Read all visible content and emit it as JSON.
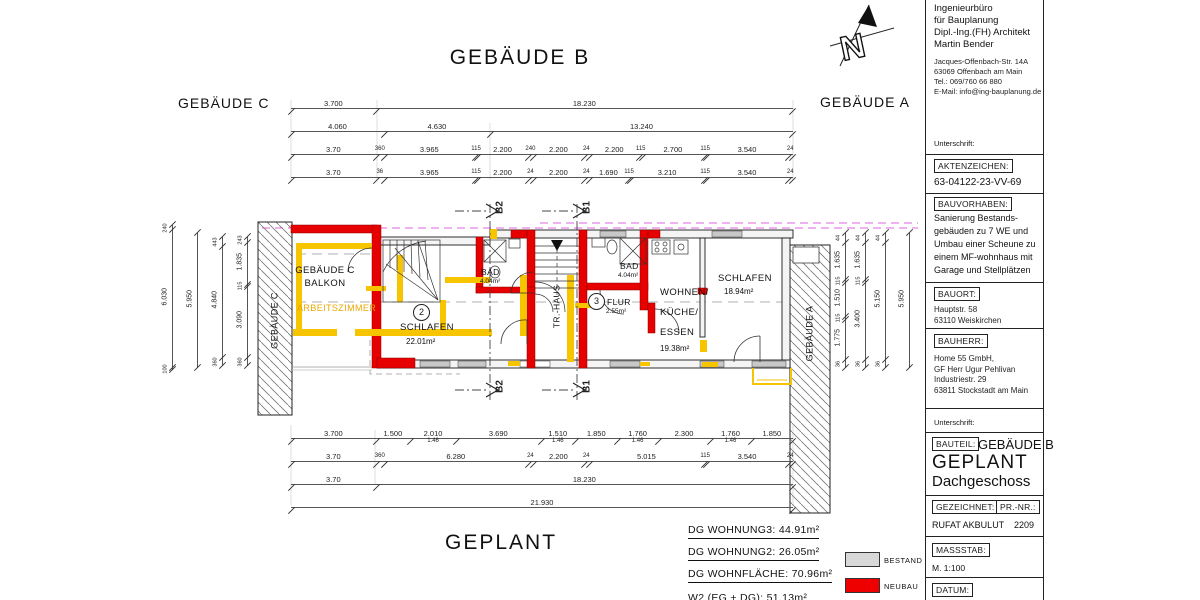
{
  "compass": {
    "n": "N"
  },
  "headings": {
    "building_b": "GEBÄUDE B",
    "building_c": "GEBÄUDE C",
    "building_a": "GEBÄUDE A",
    "caption": "GEPLANT"
  },
  "plan": {
    "strip_left": "GEBÄUDE C",
    "strip_right": "GEBÄUDE A",
    "balkon_line1": "GEBÄUDE C",
    "balkon_line2": "BALKON",
    "arbeitszimmer": "ARBEITSZIMMER",
    "schlafen2_num": "2",
    "schlafen2_name": "SCHLAFEN",
    "schlafen2_area": "22.01m²",
    "bad_left_name": "BAD",
    "bad_left_area": "4.04m²",
    "trhaus": "TR.-HAUS",
    "bad_right_name": "BAD",
    "bad_right_area": "4.04m²",
    "flur_num": "3",
    "flur_name": "FLUR",
    "flur_area": "2.55m²",
    "wohnen_line1": "WOHNEN/",
    "wohnen_line2": "KÜCHE/",
    "wohnen_line3": "ESSEN",
    "wohnen_area": "19.38m²",
    "schlafen1_name": "SCHLAFEN",
    "schlafen1_area": "18.94m²",
    "section_b1": "B1",
    "section_b2": "B2"
  },
  "dims": {
    "top_rows": [
      [
        {
          "t": "3.700",
          "w": 3.7
        },
        {
          "t": "18.230",
          "w": 18.23
        }
      ],
      [
        {
          "t": "4.060",
          "w": 4.06
        },
        {
          "t": "4.630",
          "w": 4.63
        },
        {
          "t": "13.240",
          "w": 13.24
        }
      ],
      [
        {
          "t": "3.70",
          "w": 3.7
        },
        {
          "t": "360",
          "w": 0.36
        },
        {
          "t": "3.965",
          "w": 3.965
        },
        {
          "t": "115",
          "w": 0.115
        },
        {
          "t": "2.200",
          "w": 2.2
        },
        {
          "t": "240",
          "w": 0.24
        },
        {
          "t": "2.200",
          "w": 2.2
        },
        {
          "t": "24",
          "w": 0.24
        },
        {
          "t": "2.200",
          "w": 2.2
        },
        {
          "t": "115",
          "w": 0.115
        },
        {
          "t": "2.700",
          "w": 2.7
        },
        {
          "t": "115",
          "w": 0.115
        },
        {
          "t": "3.540",
          "w": 3.54
        },
        {
          "t": "24",
          "w": 0.24
        }
      ],
      [
        {
          "t": "3.70",
          "w": 3.7
        },
        {
          "t": "36",
          "w": 0.36
        },
        {
          "t": "3.965",
          "w": 3.965
        },
        {
          "t": "115",
          "w": 0.115
        },
        {
          "t": "2.200",
          "w": 2.2
        },
        {
          "t": "24",
          "w": 0.24
        },
        {
          "t": "2.200",
          "w": 2.2
        },
        {
          "t": "24",
          "w": 0.24
        },
        {
          "t": "1.690",
          "w": 1.69
        },
        {
          "t": "115",
          "w": 0.115
        },
        {
          "t": "3.210",
          "w": 3.21
        },
        {
          "t": "115",
          "w": 0.115
        },
        {
          "t": "3.540",
          "w": 3.54
        },
        {
          "t": "24",
          "w": 0.24
        }
      ]
    ],
    "bottom_rows": [
      [
        {
          "t": "3.700",
          "w": 3.7
        },
        {
          "t": "1.500",
          "w": 1.5
        },
        {
          "t": "2.010",
          "w": 2.01,
          "sub": "1.46"
        },
        {
          "t": "3.690",
          "w": 3.69
        },
        {
          "t": "1.510",
          "w": 1.51,
          "sub": "1.46"
        },
        {
          "t": "1.850",
          "w": 1.85
        },
        {
          "t": "1.760",
          "w": 1.76,
          "sub": "1.46"
        },
        {
          "t": "2.300",
          "w": 2.3
        },
        {
          "t": "1.760",
          "w": 1.76,
          "sub": "1.46"
        },
        {
          "t": "1.850",
          "w": 1.85
        }
      ],
      [
        {
          "t": "3.70",
          "w": 3.7
        },
        {
          "t": "360",
          "w": 0.36
        },
        {
          "t": "6.280",
          "w": 6.28
        },
        {
          "t": "24",
          "w": 0.24
        },
        {
          "t": "2.200",
          "w": 2.2
        },
        {
          "t": "24",
          "w": 0.24
        },
        {
          "t": "5.015",
          "w": 5.015
        },
        {
          "t": "115",
          "w": 0.115
        },
        {
          "t": "3.540",
          "w": 3.54
        },
        {
          "t": "24",
          "w": 0.24
        }
      ],
      [
        {
          "t": "3.70",
          "w": 3.7
        },
        {
          "t": "18.230",
          "w": 18.23
        }
      ],
      [
        {
          "t": "21.930",
          "w": 21.93
        }
      ]
    ],
    "left_cols": [
      [
        {
          "t": "240",
          "w": 0.24
        },
        {
          "t": "6.030",
          "w": 6.03
        },
        {
          "t": "100",
          "w": 0.1
        }
      ],
      [
        {
          "t": "5.950",
          "w": 5.95
        }
      ],
      [
        {
          "t": "443",
          "w": 0.443
        },
        {
          "t": "4.840",
          "w": 4.84
        },
        {
          "t": "360",
          "w": 0.36
        }
      ],
      [
        {
          "t": "243",
          "w": 0.243
        },
        {
          "t": "1.835",
          "w": 1.835
        },
        {
          "t": "115",
          "w": 0.115
        },
        {
          "t": "3.090",
          "w": 3.09
        },
        {
          "t": "360",
          "w": 0.36
        }
      ]
    ],
    "right_cols": [
      [
        {
          "t": "44",
          "w": 0.44
        },
        {
          "t": "1.635",
          "w": 1.635
        },
        {
          "t": "115",
          "w": 0.115
        },
        {
          "t": "1.510",
          "w": 1.51
        },
        {
          "t": "115",
          "w": 0.115
        },
        {
          "t": "1.775",
          "w": 1.775
        },
        {
          "t": "36",
          "w": 0.36
        }
      ],
      [
        {
          "t": "44",
          "w": 0.44
        },
        {
          "t": "1.635",
          "w": 1.635
        },
        {
          "t": "115",
          "w": 0.115
        },
        {
          "t": "3.400",
          "w": 3.4
        },
        {
          "t": "36",
          "w": 0.36
        }
      ],
      [
        {
          "t": "44",
          "w": 0.44
        },
        {
          "t": "5.150",
          "w": 5.15
        },
        {
          "t": "36",
          "w": 0.36
        }
      ],
      [
        {
          "t": "5.950",
          "w": 5.95
        }
      ]
    ]
  },
  "summary": {
    "items": [
      {
        "label": "DG WOHNUNG3:",
        "value": "44.91m²",
        "underline": true
      },
      {
        "label": "DG WOHNUNG2:",
        "value": "26.05m²",
        "underline": true
      },
      {
        "label": "DG WOHNFLÄCHE:",
        "value": "70.96m²",
        "underline": true
      },
      {
        "label": "W2 (EG + DG):",
        "value": "51.13m²",
        "underline": false
      }
    ]
  },
  "legend": {
    "bestand_label": "BESTAND",
    "bestand_color": "#d8d8d8",
    "neubau_label": "NEUBAU",
    "neubau_color": "#ee0000"
  },
  "titleblock": {
    "firm_lines": [
      "Ingenieurbüro",
      "für Bauplanung",
      "Dipl.-Ing.(FH) Architekt",
      "Martin Bender"
    ],
    "address_lines": [
      "Jacques-Offenbach-Str. 14A",
      "63069 Offenbach am Main",
      "Tel.: 069/760 66 880",
      "E-Mail: info@ing-bauplanung.de"
    ],
    "signature_label": "Unterschrift:",
    "aktenzeichen_label": "AKTENZEICHEN:",
    "aktenzeichen_value": "63-04122-23-VV-69",
    "bauvorhaben_label": "BAUVORHABEN:",
    "bauvorhaben_lines": [
      "Sanierung Bestands-",
      "gebäuden zu 7 WE und",
      "Umbau einer Scheune zu",
      "einem MF-wohnhaus mit",
      "Garage und Stellplätzen"
    ],
    "bauort_label": "BAUORT:",
    "bauort_lines": [
      "Hauptstr. 58",
      "63110 Weiskirchen"
    ],
    "bauherr_label": "BAUHERR:",
    "bauherr_lines": [
      "Home 55 GmbH,",
      "GF Herr Ugur Pehlivan",
      "Industriestr. 29",
      "63811 Stockstadt am Main"
    ],
    "signature2_label": "Unterschrift:",
    "bauteil_label": "BAUTEIL:",
    "bauteil_value": "GEBÄUDE B",
    "plan_state": "GEPLANT",
    "level": "Dachgeschoss",
    "gezeichnet_label": "GEZEICHNET:",
    "gezeichnet_value": "RUFAT AKBULUT",
    "prnr_label": "PR.-NR.:",
    "prnr_value": "2209",
    "massstab_label": "MASSSTAB:",
    "massstab_value": "M. 1:100",
    "datum_label": "DATUM:"
  }
}
